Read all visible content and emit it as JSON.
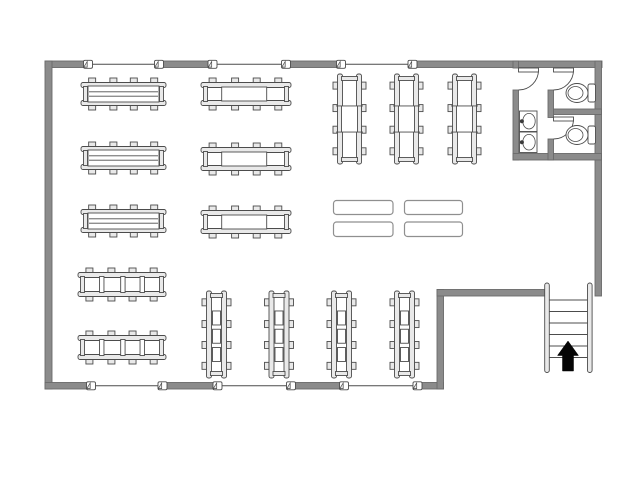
{
  "title": "Retail store floor plan",
  "canvas": {
    "width": 640,
    "height": 480,
    "bg": "#ffffff"
  },
  "colors": {
    "wall": "#8b8b8b",
    "wallEdge": "#6a6a6a",
    "line": "#4c4c4c",
    "lightFill": "#e9e9e9",
    "white": "#ffffff",
    "tableStroke": "#8f8f8f",
    "faucet": "#3a3a3a",
    "arrow": "#050505"
  },
  "walls": [
    {
      "name": "wall-top",
      "r": [
        45,
        61,
        557,
        6.5
      ]
    },
    {
      "name": "wall-left",
      "r": [
        45,
        61,
        7,
        328
      ]
    },
    {
      "name": "wall-bottom",
      "r": [
        45,
        382.5,
        398.5,
        6.5
      ]
    },
    {
      "name": "wall-right",
      "r": [
        595,
        61,
        6.5,
        235
      ]
    },
    {
      "name": "wall-notch-vertical",
      "r": [
        437,
        289.5,
        6.5,
        99.5
      ]
    },
    {
      "name": "wall-notch-horizontal",
      "r": [
        437,
        289.5,
        109,
        6.5
      ]
    }
  ],
  "windows": {
    "runs": [
      {
        "x1": 88,
        "x2": 159,
        "y": 60.5,
        "h": 7.5
      },
      {
        "x1": 212.5,
        "x2": 286,
        "y": 60.5,
        "h": 7.5
      },
      {
        "x1": 341,
        "x2": 412.5,
        "y": 60.5,
        "h": 7.5
      },
      {
        "x1": 91,
        "x2": 162.5,
        "y": 382,
        "h": 7.5
      },
      {
        "x1": 217.5,
        "x2": 291,
        "y": 382,
        "h": 7.5
      },
      {
        "x1": 344,
        "x2": 417.5,
        "y": 382,
        "h": 7.5
      }
    ],
    "markers": [
      {
        "cx": 88,
        "cy": 64.3
      },
      {
        "cx": 159,
        "cy": 64.3
      },
      {
        "cx": 212.5,
        "cy": 64.3
      },
      {
        "cx": 286,
        "cy": 64.3
      },
      {
        "cx": 341,
        "cy": 64.3
      },
      {
        "cx": 412.5,
        "cy": 64.3
      },
      {
        "cx": 91,
        "cy": 385.8
      },
      {
        "cx": 162.5,
        "cy": 385.8
      },
      {
        "cx": 217.5,
        "cy": 385.8
      },
      {
        "cx": 291,
        "cy": 385.8
      },
      {
        "cx": 344,
        "cy": 385.8
      },
      {
        "cx": 417.5,
        "cy": 385.8
      }
    ]
  },
  "shelves": [
    {
      "name": "gondola-shelf-unit",
      "o": "h",
      "inner": "wide",
      "x": 81,
      "y": 78,
      "w": 85,
      "h": 32
    },
    {
      "name": "gondola-shelf-unit",
      "o": "h",
      "inner": "wide",
      "x": 81,
      "y": 142,
      "w": 85,
      "h": 32
    },
    {
      "name": "gondola-shelf-unit",
      "o": "h",
      "inner": "wide",
      "x": 81,
      "y": 205,
      "w": 85,
      "h": 32
    },
    {
      "name": "gondola-shelf-unit",
      "o": "h",
      "inner": "center",
      "x": 201,
      "y": 78,
      "w": 90,
      "h": 32
    },
    {
      "name": "gondola-shelf-unit",
      "o": "h",
      "inner": "center",
      "x": 201,
      "y": 143,
      "w": 90,
      "h": 32
    },
    {
      "name": "gondola-shelf-unit",
      "o": "h",
      "inner": "center",
      "x": 201,
      "y": 206,
      "w": 90,
      "h": 32
    },
    {
      "name": "gondola-shelf-unit",
      "o": "v",
      "inner": "square",
      "x": 333,
      "y": 74,
      "w": 33,
      "h": 90
    },
    {
      "name": "gondola-shelf-unit",
      "o": "v",
      "inner": "square",
      "x": 390,
      "y": 74,
      "w": 33,
      "h": 90
    },
    {
      "name": "gondola-shelf-unit",
      "o": "v",
      "inner": "square",
      "x": 448,
      "y": 74,
      "w": 33,
      "h": 90
    },
    {
      "name": "rack-shelf-unit",
      "o": "h",
      "inner": "slats",
      "x": 78,
      "y": 268,
      "w": 88,
      "h": 33
    },
    {
      "name": "rack-shelf-unit",
      "o": "h",
      "inner": "slats",
      "x": 78,
      "y": 331,
      "w": 88,
      "h": 33
    },
    {
      "name": "rack-shelf-unit",
      "o": "v",
      "inner": "boxes",
      "x": 202,
      "y": 291,
      "w": 29,
      "h": 87
    },
    {
      "name": "rack-shelf-unit",
      "o": "v",
      "inner": "boxes",
      "x": 264.5,
      "y": 291,
      "w": 29,
      "h": 87
    },
    {
      "name": "rack-shelf-unit",
      "o": "v",
      "inner": "boxes",
      "x": 327,
      "y": 291,
      "w": 29,
      "h": 87
    },
    {
      "name": "rack-shelf-unit",
      "o": "v",
      "inner": "boxes",
      "x": 390,
      "y": 291,
      "w": 29,
      "h": 87
    }
  ],
  "tables": [
    [
      333.5,
      200.5,
      59.5,
      14
    ],
    [
      404.5,
      200.5,
      58,
      14
    ],
    [
      333.5,
      222,
      59.5,
      14.5
    ],
    [
      404.5,
      222,
      58,
      14.5
    ]
  ],
  "restroom": {
    "walls": [
      {
        "name": "restroom-wall-left",
        "r": [
          513,
          61,
          5.5,
          7
        ]
      },
      {
        "name": "restroom-wall-left",
        "r": [
          513,
          90,
          5.5,
          70
        ]
      },
      {
        "name": "restroom-wall-bottom",
        "r": [
          513,
          153.5,
          88.5,
          6.5
        ]
      },
      {
        "name": "restroom-wall-middle",
        "r": [
          548,
          90,
          5.5,
          27.5
        ]
      },
      {
        "name": "restroom-wall-middle",
        "r": [
          548,
          139,
          5.5,
          21
        ]
      },
      {
        "name": "restroom-stall-divider",
        "r": [
          553.5,
          109,
          48,
          5.5
        ]
      }
    ],
    "doors": [
      {
        "leaf": [
          518.5,
          68,
          20,
          4
        ],
        "arc": "M 538.5 70 A 20 20 0 0 1 518.5 90"
      },
      {
        "leaf": [
          553.5,
          68,
          20,
          4
        ],
        "arc": "M 573.5 70 A 20 20 0 0 1 553.5 90"
      },
      {
        "leaf": [
          553.5,
          117,
          20,
          4
        ],
        "arc": "M 573.5 119 A 20 20 0 0 1 553.5 139"
      }
    ],
    "toilets": [
      {
        "cx": 577,
        "cy": 93
      },
      {
        "cx": 577,
        "cy": 135
      }
    ],
    "sinks": [
      {
        "x": 519.5,
        "y": 111
      },
      {
        "x": 519.5,
        "y": 132
      }
    ]
  },
  "stairs": {
    "x1": 549.5,
    "x2": 587.5,
    "yTop": 283,
    "len": 89.5,
    "steps": [
      300,
      311.5,
      323,
      334.5,
      346,
      357.5
    ],
    "arrow": "568,341 578.5,355.5 573.5,355.5 573.5,371 562.5,371 562.5,355.5 557.5,355.5"
  }
}
